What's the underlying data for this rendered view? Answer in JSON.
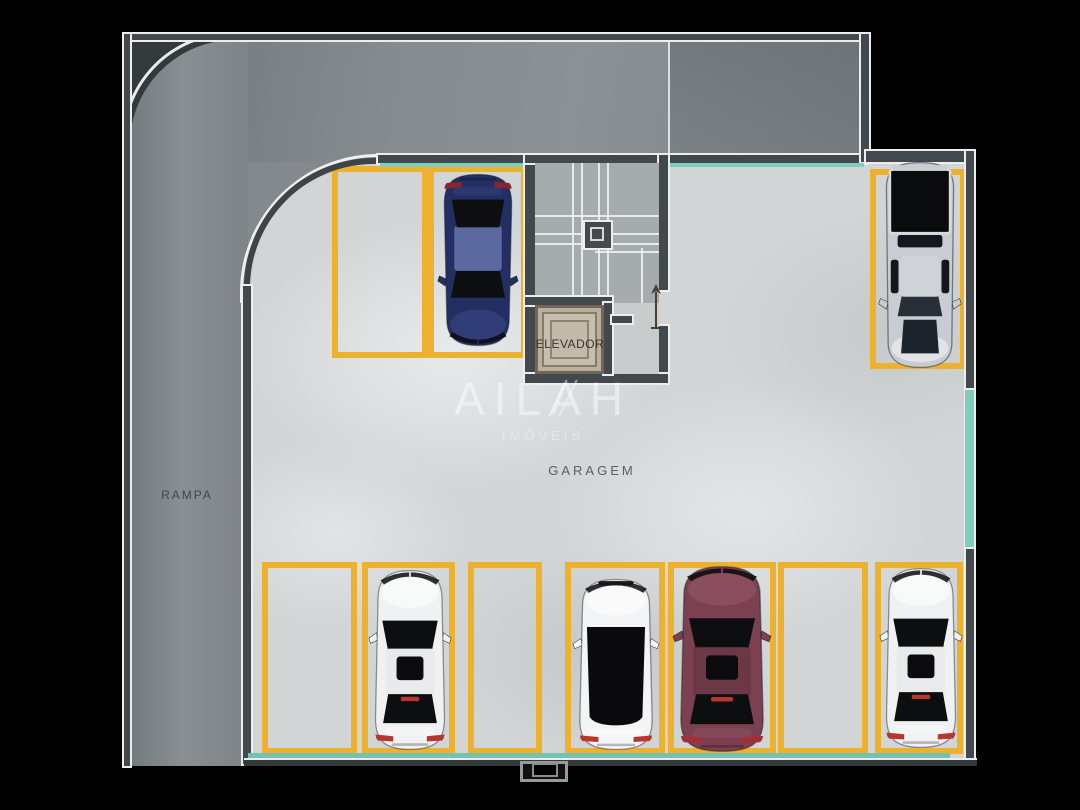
{
  "background": "#000000",
  "labels": {
    "ramp": "RAMPA",
    "garage": "GARAGEM",
    "elevator": "ELEVADOR"
  },
  "watermark": {
    "name": "AILAH",
    "tagline": "IMÓVEIS"
  },
  "palette": {
    "parking_line_yellow": "#eeb12e",
    "glass_teal": "#7fcdbd",
    "wall_dark": "#43484c",
    "wall_outline_white": "#eceeee",
    "floor_concrete": "#d2d5d6",
    "ramp_gray": "#868c90",
    "elevator_beige": "#c3baa9",
    "stair_gray": "#a6abae"
  },
  "parking_spaces": [
    {
      "id": "top-1",
      "x": 332,
      "y": 166,
      "w": 96,
      "h": 192,
      "occupied": false
    },
    {
      "id": "top-2",
      "x": 428,
      "y": 166,
      "w": 99,
      "h": 192,
      "occupied": true
    },
    {
      "id": "bay-1",
      "x": 870,
      "y": 169,
      "w": 96,
      "h": 200,
      "occupied": true
    },
    {
      "id": "bottom-1",
      "x": 262,
      "y": 562,
      "w": 95,
      "h": 192,
      "occupied": false
    },
    {
      "id": "bottom-2",
      "x": 362,
      "y": 562,
      "w": 93,
      "h": 192,
      "occupied": true
    },
    {
      "id": "bottom-3",
      "x": 468,
      "y": 562,
      "w": 74,
      "h": 192,
      "occupied": false
    },
    {
      "id": "bottom-4",
      "x": 565,
      "y": 562,
      "w": 100,
      "h": 192,
      "occupied": true
    },
    {
      "id": "bottom-5",
      "x": 668,
      "y": 562,
      "w": 108,
      "h": 192,
      "occupied": true
    },
    {
      "id": "bottom-6",
      "x": 778,
      "y": 562,
      "w": 90,
      "h": 192,
      "occupied": false
    },
    {
      "id": "bottom-7",
      "x": 875,
      "y": 562,
      "w": 88,
      "h": 192,
      "occupied": true
    }
  ],
  "cars": [
    {
      "id": "car-blue-suv",
      "style": "sedan",
      "x": 437,
      "y": 172,
      "w": 82,
      "h": 176,
      "rotation": 180,
      "body": "#232e63",
      "roof": "#5c68a0",
      "highlight": "#3e4a86",
      "tail": "#8c2430",
      "sunroof": false,
      "brake": false
    },
    {
      "id": "car-silver-pickup",
      "style": "pickup",
      "x": 877,
      "y": 159,
      "w": 86,
      "h": 212,
      "rotation": 180,
      "body": "#c9cdd3"
    },
    {
      "id": "car-white-sedan-1",
      "style": "sedan",
      "x": 368,
      "y": 568,
      "w": 84,
      "h": 184,
      "rotation": 0,
      "body": "#eff1f2",
      "roof": "#e8eaec",
      "highlight": "#ffffff",
      "tail": "#b9362f",
      "sunroof": true,
      "brake": true
    },
    {
      "id": "car-white-hatch",
      "style": "sedan-blackroof",
      "x": 572,
      "y": 577,
      "w": 88,
      "h": 175,
      "rotation": 0,
      "body": "#f3f4f5",
      "roof": "#0a0a0c",
      "highlight": "#ffffff",
      "tail": "#b9362f",
      "sunroof": false,
      "brake": false
    },
    {
      "id": "car-maroon-sedan",
      "style": "sedan",
      "x": 672,
      "y": 564,
      "w": 100,
      "h": 190,
      "rotation": 0,
      "body": "#7c4150",
      "roof": "#6d3845",
      "highlight": "#95596a",
      "tail": "#a52e35",
      "sunroof": true,
      "brake": true
    },
    {
      "id": "car-white-sedan-2",
      "style": "sedan",
      "x": 879,
      "y": 566,
      "w": 84,
      "h": 184,
      "rotation": 0,
      "body": "#eff1f2",
      "roof": "#e8eaec",
      "highlight": "#ffffff",
      "tail": "#b9362f",
      "sunroof": true,
      "brake": true
    }
  ]
}
